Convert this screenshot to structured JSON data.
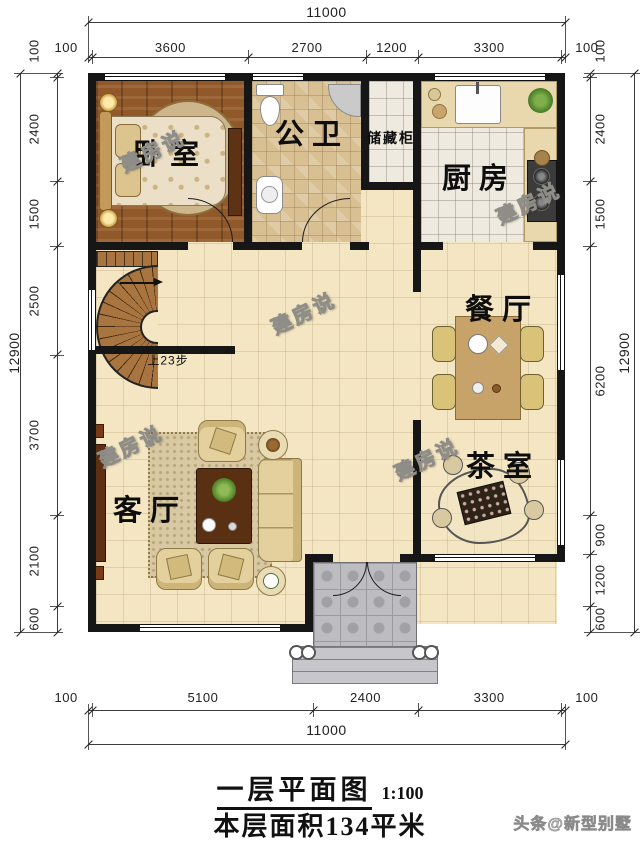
{
  "plan": {
    "watermark": "建房说",
    "stairs_note": "上23步",
    "rooms": {
      "bedroom": "卧室",
      "bathroom": "公卫",
      "storage": "储藏柜",
      "kitchen": "厨房",
      "dining": "餐厅",
      "tea": "茶室",
      "living": "客厅"
    }
  },
  "dimensions": {
    "top": {
      "total": "11000",
      "segments": [
        "100",
        "3600",
        "2700",
        "1200",
        "3300",
        "100"
      ]
    },
    "bottom": {
      "total": "11000",
      "segments": [
        "100",
        "5100",
        "2400",
        "3300",
        "100"
      ]
    },
    "left": {
      "total": "12900",
      "segments": [
        "100",
        "2400",
        "1500",
        "2500",
        "3700",
        "2100",
        "600"
      ]
    },
    "right": {
      "total": "12900",
      "segments": [
        "100",
        "2400",
        "1500",
        "6200",
        "900",
        "1200",
        "600"
      ]
    }
  },
  "footer": {
    "title": "一层平面图",
    "scale": "1:100",
    "area": "本层面积134平米",
    "credit": "头条@新型别墅"
  },
  "colors": {
    "wall": "#161616",
    "cream_tile": "#f4e6c2",
    "wood": "#91582a",
    "porch": "#bcbcc1"
  }
}
